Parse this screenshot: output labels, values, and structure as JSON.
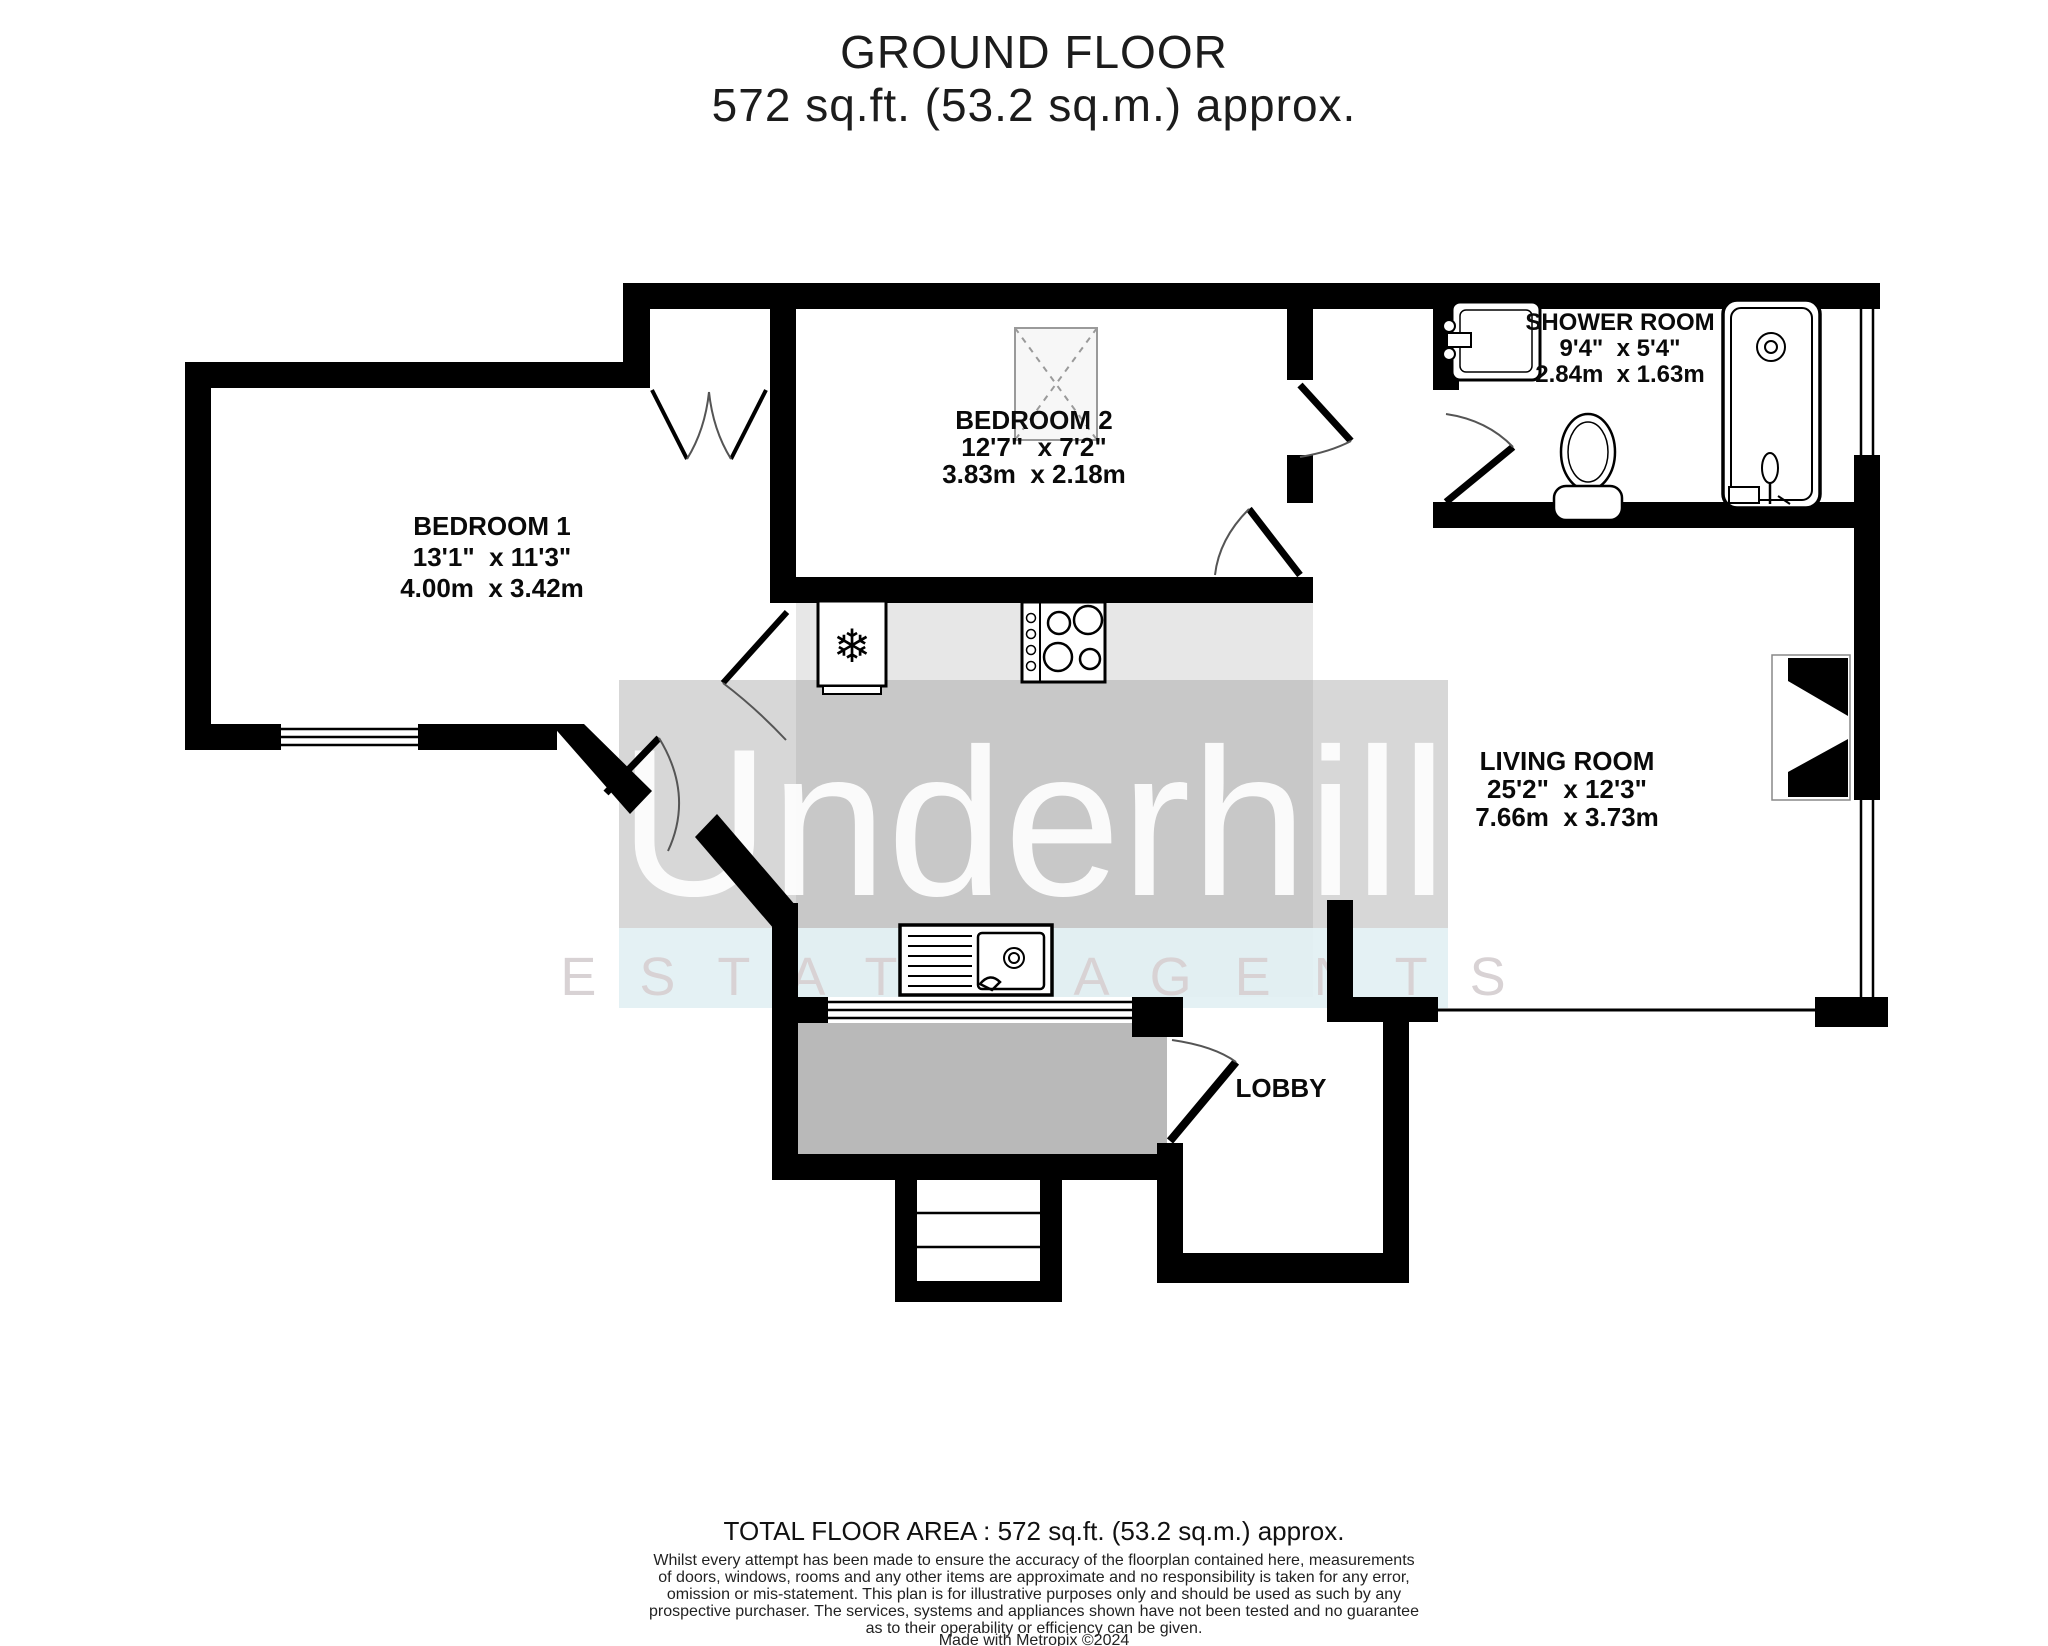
{
  "title": {
    "line1": "GROUND FLOOR",
    "line2": "572 sq.ft. (53.2 sq.m.) approx."
  },
  "rooms": {
    "bedroom1": {
      "name": "BEDROOM 1",
      "imperial": "13'1\"  x 11'3\"",
      "metric": "4.00m  x 3.42m"
    },
    "bedroom2": {
      "name": "BEDROOM 2",
      "imperial": "12'7\"  x 7'2\"",
      "metric": "3.83m  x 2.18m"
    },
    "shower": {
      "name": "SHOWER ROOM",
      "imperial": "9'4\"  x 5'4\"",
      "metric": "2.84m  x 1.63m"
    },
    "living": {
      "name": "LIVING ROOM",
      "imperial": "25'2\"  x 12'3\"",
      "metric": "7.66m  x 3.73m"
    },
    "lobby": {
      "name": "LOBBY"
    }
  },
  "watermark": {
    "brand": "Underhill",
    "tagline": "E S T A T E   A G E N T S"
  },
  "fixtures": {
    "fridge_glyph": "❄",
    "names": [
      "fridge-freezer",
      "hob",
      "kitchen-sink",
      "wash-basin",
      "toilet",
      "shower-enclosure",
      "wardrobe",
      "chimney-breast",
      "steps",
      "front-door"
    ]
  },
  "footer": {
    "total_area": "TOTAL FLOOR AREA : 572 sq.ft. (53.2 sq.m.) approx.",
    "disclaimer": [
      "Whilst every attempt has been made to ensure the accuracy of the floorplan contained here, measurements",
      "of doors, windows, rooms and any other items are approximate and no responsibility is taken for any error,",
      "omission or mis-statement. This plan is for illustrative purposes only and should be used as such by any",
      "prospective purchaser. The services, systems and appliances shown have not been tested and no guarantee",
      "as to their operability or efficiency can be given."
    ],
    "credit": "Made with Metropix ©2024"
  },
  "colors": {
    "wall": "#000000",
    "kitchen_floor": "#e7e7e7",
    "porch_fill": "#b9b9b9",
    "watermark_band": "#d6d6d6",
    "tagline_band": "#e9f3f5",
    "brand_text": "#ffffff",
    "tagline_text": "#d8d2d4",
    "label_text": "#0a0a0a"
  }
}
